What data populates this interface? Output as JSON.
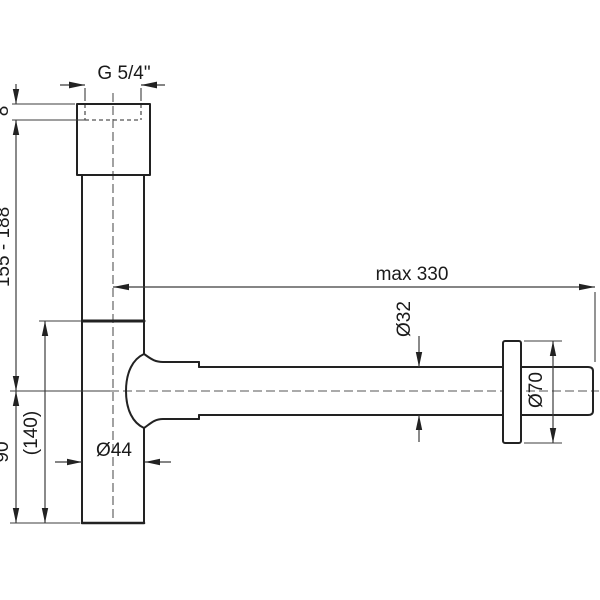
{
  "drawing": {
    "labels": {
      "thread": "G 5/4\"",
      "thread_depth": "8",
      "trap_height_range": "155 - 188",
      "outlet_height": "90",
      "total_height_ref": "(140)",
      "body_diameter": "Ø44",
      "wall_distance_max": "max 330",
      "pipe_diameter": "Ø32",
      "rosette_diameter": "Ø70"
    },
    "colors": {
      "background": "#ffffff",
      "outline": "#222222",
      "dimension": "#3c3c3c",
      "centerline": "#555555",
      "text": "#1a1a1a"
    }
  }
}
